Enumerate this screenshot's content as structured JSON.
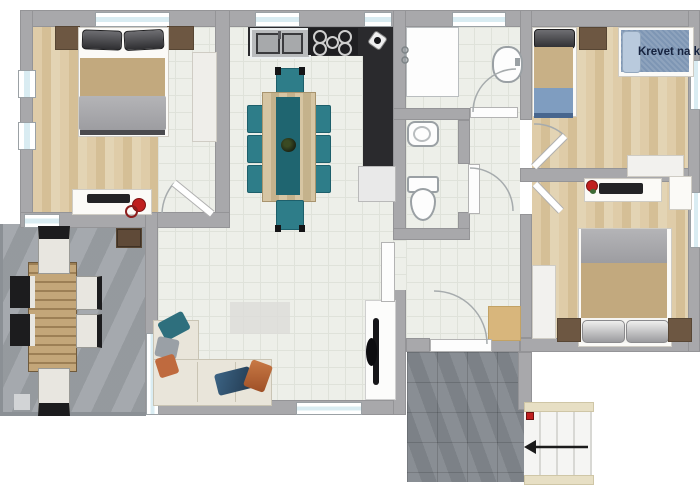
{
  "image": {
    "kind": "apartment floor plan render",
    "width_px": 700,
    "height_px": 500
  },
  "labels": {
    "bunk_bed_label": "Krevet na kat"
  },
  "stairs": {
    "arrow_direction": "left"
  },
  "rooms": {
    "bedroom_top_left": {
      "furniture": [
        "double-bed",
        "headboard-shelves",
        "wardrobe",
        "desk",
        "laptop",
        "red-chair"
      ]
    },
    "terrace": {
      "furniture": [
        "outdoor-table",
        "six-chairs",
        "storage-cabinet"
      ]
    },
    "living_kitchen": {
      "furniture": [
        "l-shaped-counter",
        "double-sink",
        "cooktop",
        "kettle",
        "fridge-cabinet",
        "dining-table",
        "teal-chairs",
        "plant-centerpiece",
        "corner-sofa",
        "throw-pillows",
        "rug",
        "tv-stand",
        "tv"
      ]
    },
    "bathroom": {
      "furniture": [
        "shower",
        "washbasin"
      ]
    },
    "wc": {
      "furniture": [
        "bidet",
        "toilet"
      ]
    },
    "hallway": {
      "furniture": [
        "doormat"
      ]
    },
    "bedroom_top_right": {
      "furniture": [
        "single-bed",
        "nightstand",
        "bunk-bed",
        "dresser"
      ],
      "label": "Krevet na kat"
    },
    "bedroom_bottom_right": {
      "furniture": [
        "double-bed",
        "nightstands",
        "desk",
        "laptop",
        "flower",
        "wardrobe",
        "closet"
      ]
    },
    "entry": {
      "furniture": [
        "stairs",
        "smoke-marker"
      ]
    }
  },
  "colors": {
    "wall": "#a8a8ab",
    "wallEdge": "#949497",
    "wood": "#d9c5a0",
    "tile": "#edefe9",
    "terrace": "#9ea3a8",
    "entryTile": "#83888e",
    "counter": "#2a2a2d",
    "steel": "#b9bbbd",
    "teal": "#2e7d89",
    "tealDark": "#1f6570",
    "tableWood": "#cfbb93",
    "sofa": "#e9e5da",
    "pillowTeal": "#2e6f7d",
    "pillowOrange": "#bf6a3e",
    "pillowNavy": "#2d4f6e",
    "pillowGray": "#9aa0a6",
    "blanketTan": "#c2a97e",
    "blanketBlue": "#7f9dc0",
    "blanketNavy": "#48668e",
    "denim": "#7e96b4",
    "denimPillow": "#b9cadd",
    "throwGray": "#a9a9ad",
    "brown": "#6d5742",
    "labelNavy": "#16233f",
    "red": "#c01f1f",
    "stairsEdge": "#e7dfc4",
    "mat": "#d8b67c",
    "door": "#fdfdfd"
  }
}
